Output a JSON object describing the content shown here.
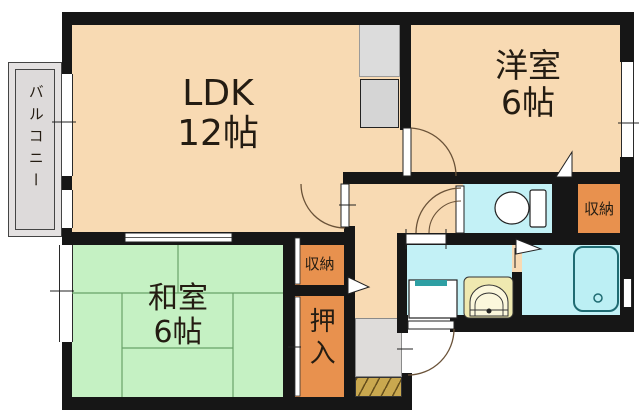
{
  "floorplan": {
    "rooms": {
      "ldk": {
        "label": "LDK",
        "size": "12帖"
      },
      "western_room": {
        "label": "洋室",
        "size": "6帖"
      },
      "japanese_room": {
        "label": "和室",
        "size": "6帖"
      },
      "balcony": {
        "label": "バルコニー"
      },
      "storage_hall": {
        "label": "収納"
      },
      "storage_west": {
        "label": "収納"
      },
      "oshiire": {
        "label": "押入"
      }
    },
    "icons": {
      "toilet": "toilet-icon",
      "bathtub": "bathtub-icon",
      "washbasin": "washbasin-icon",
      "washing_machine_pan": "washing-machine-pan-icon",
      "entrance_step": "entrance-step-hatch",
      "door_swing": "door-swing-arc"
    },
    "colors": {
      "wall": "#161616",
      "room_peach": "#F8DAB3",
      "tatami_green": "#C5F1C3",
      "storage_orange": "#E8914E",
      "water_cyan": "#C3F1F6",
      "bathtub_cyan": "#BCEFF4",
      "genkan_gray": "#DEDCDA",
      "balcony_gray": "#E4E1E1",
      "step_tan": "#C9A84F",
      "basin_yellow": "#EFE9B0",
      "teal_accent": "#2E9FA3"
    }
  }
}
